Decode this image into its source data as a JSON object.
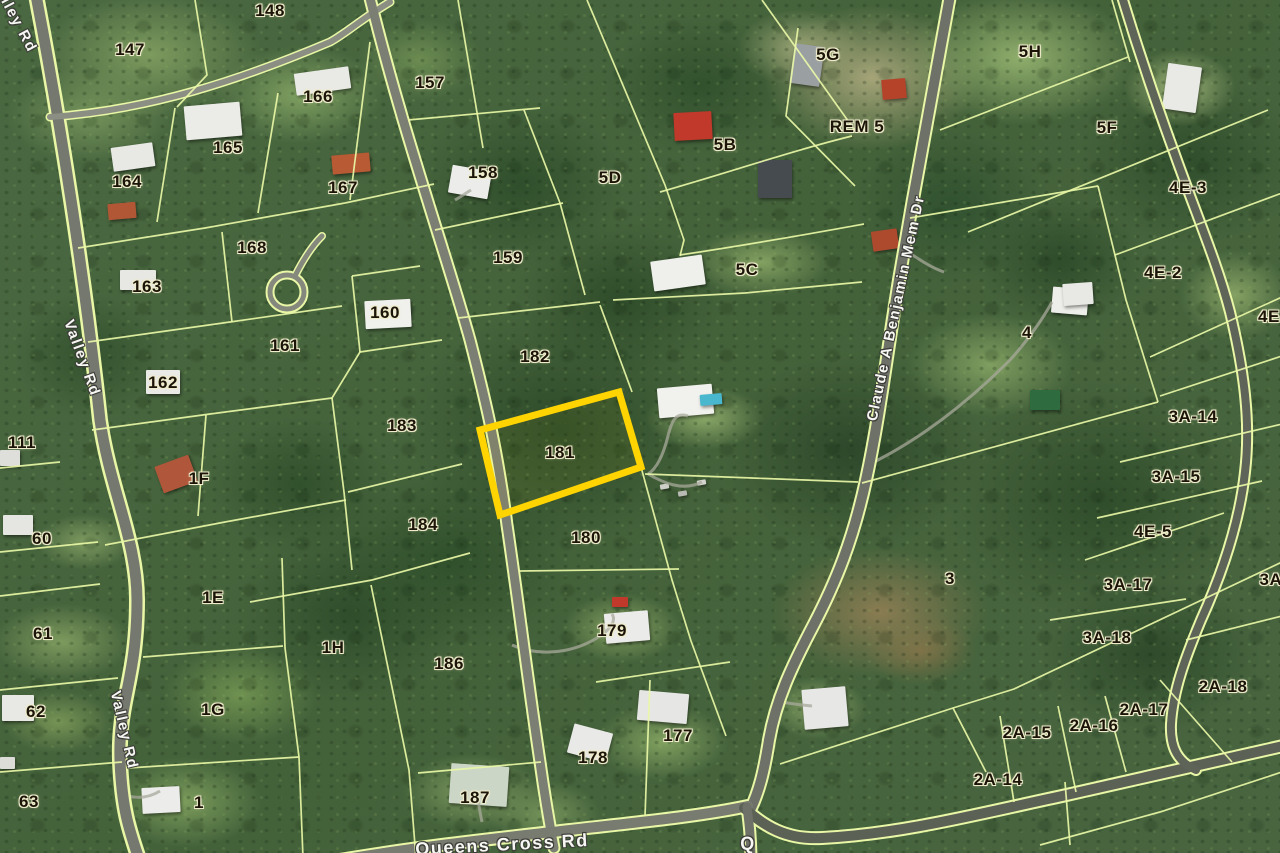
{
  "map": {
    "description": "Aerial parcel (cadastral) map with highlighted lot",
    "highlighted_parcel": {
      "id": "181",
      "outline_color": "#FFD400",
      "points": "480,430 619,392 641,467 500,515"
    },
    "parcel_labels": [
      {
        "t": "147",
        "x": 130,
        "y": 50
      },
      {
        "t": "148",
        "x": 270,
        "y": 11
      },
      {
        "t": "157",
        "x": 430,
        "y": 83
      },
      {
        "t": "166",
        "x": 318,
        "y": 97
      },
      {
        "t": "165",
        "x": 228,
        "y": 148
      },
      {
        "t": "164",
        "x": 127,
        "y": 182
      },
      {
        "t": "167",
        "x": 343,
        "y": 188
      },
      {
        "t": "5D",
        "x": 610,
        "y": 178
      },
      {
        "t": "5B",
        "x": 725,
        "y": 145
      },
      {
        "t": "5G",
        "x": 828,
        "y": 55
      },
      {
        "t": "REM 5",
        "x": 857,
        "y": 127
      },
      {
        "t": "5H",
        "x": 1030,
        "y": 52
      },
      {
        "t": "5F",
        "x": 1107,
        "y": 128
      },
      {
        "t": "4E-3",
        "x": 1188,
        "y": 188
      },
      {
        "t": "168",
        "x": 252,
        "y": 248
      },
      {
        "t": "158",
        "x": 483,
        "y": 173
      },
      {
        "t": "159",
        "x": 508,
        "y": 258
      },
      {
        "t": "163",
        "x": 147,
        "y": 287
      },
      {
        "t": "161",
        "x": 285,
        "y": 346
      },
      {
        "t": "160",
        "x": 385,
        "y": 313
      },
      {
        "t": "162",
        "x": 163,
        "y": 383
      },
      {
        "t": "182",
        "x": 535,
        "y": 357
      },
      {
        "t": "183",
        "x": 402,
        "y": 426
      },
      {
        "t": "181",
        "x": 560,
        "y": 453
      },
      {
        "t": "184",
        "x": 423,
        "y": 525
      },
      {
        "t": "180",
        "x": 586,
        "y": 538
      },
      {
        "t": "5C",
        "x": 747,
        "y": 270
      },
      {
        "t": "4E-2",
        "x": 1163,
        "y": 273
      },
      {
        "t": "4",
        "x": 1027,
        "y": 333
      },
      {
        "t": "4E-",
        "x": 1272,
        "y": 317
      },
      {
        "t": "3A-14",
        "x": 1193,
        "y": 417
      },
      {
        "t": "3A-15",
        "x": 1176,
        "y": 477
      },
      {
        "t": "4E-5",
        "x": 1153,
        "y": 532
      },
      {
        "t": "3A-17",
        "x": 1128,
        "y": 585
      },
      {
        "t": "3A-",
        "x": 1274,
        "y": 580
      },
      {
        "t": "3A-18",
        "x": 1107,
        "y": 638
      },
      {
        "t": "3",
        "x": 950,
        "y": 579
      },
      {
        "t": "111",
        "x": 22,
        "y": 443
      },
      {
        "t": "1F",
        "x": 199,
        "y": 479
      },
      {
        "t": "60",
        "x": 42,
        "y": 539
      },
      {
        "t": "61",
        "x": 43,
        "y": 634
      },
      {
        "t": "1E",
        "x": 213,
        "y": 598
      },
      {
        "t": "1H",
        "x": 333,
        "y": 648
      },
      {
        "t": "62",
        "x": 36,
        "y": 712
      },
      {
        "t": "1G",
        "x": 213,
        "y": 710
      },
      {
        "t": "63",
        "x": 29,
        "y": 802
      },
      {
        "t": "1",
        "x": 199,
        "y": 803
      },
      {
        "t": "186",
        "x": 449,
        "y": 664
      },
      {
        "t": "179",
        "x": 612,
        "y": 631
      },
      {
        "t": "178",
        "x": 593,
        "y": 758
      },
      {
        "t": "177",
        "x": 678,
        "y": 736
      },
      {
        "t": "187",
        "x": 475,
        "y": 798
      },
      {
        "t": "2A-18",
        "x": 1223,
        "y": 687
      },
      {
        "t": "2A-17",
        "x": 1144,
        "y": 710
      },
      {
        "t": "2A-16",
        "x": 1094,
        "y": 726
      },
      {
        "t": "2A-15",
        "x": 1027,
        "y": 733
      },
      {
        "t": "2A-14",
        "x": 998,
        "y": 780
      }
    ],
    "road_labels": [
      {
        "t": "Valley Rd",
        "x": 14,
        "y": 16,
        "r": 62
      },
      {
        "t": "Valley Rd",
        "x": 82,
        "y": 358,
        "r": 70
      },
      {
        "t": "Valley Rd",
        "x": 124,
        "y": 730,
        "r": 77
      },
      {
        "t": "Claude A Benjamin Mem Dr",
        "x": 896,
        "y": 308,
        "r": -78
      },
      {
        "t": "Queens Cross Rd",
        "x": 502,
        "y": 845,
        "r": -3,
        "fs": 18
      },
      {
        "t": "Q",
        "x": 748,
        "y": 844,
        "r": 0,
        "fs": 18
      }
    ]
  }
}
